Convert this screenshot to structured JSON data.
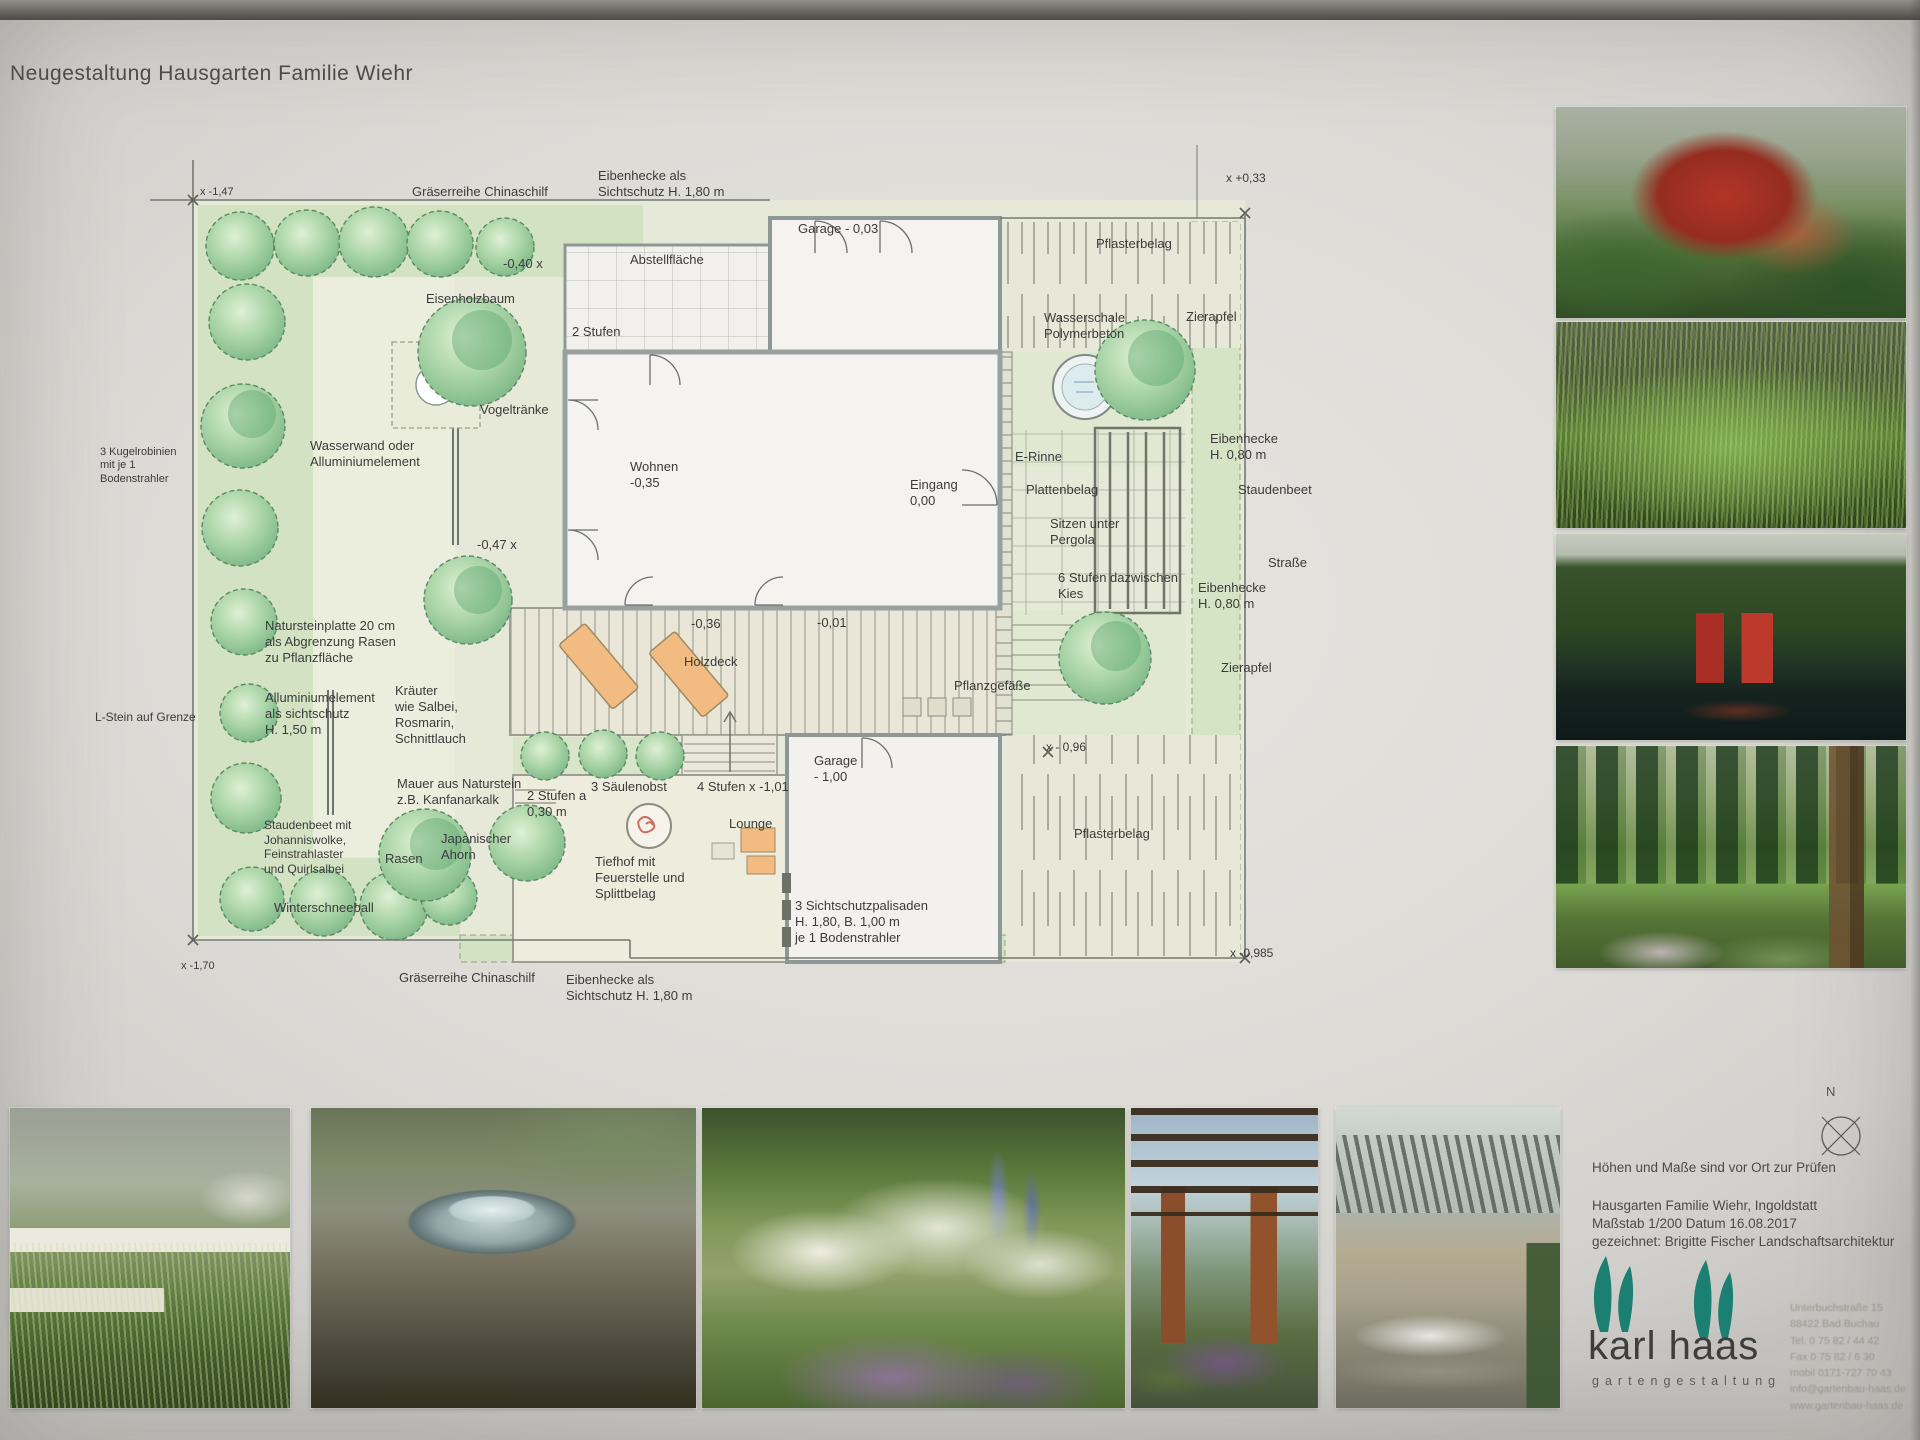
{
  "title": "Neugestaltung Hausgarten Familie Wiehr",
  "plan": {
    "labels": [
      {
        "t": "x -1,47",
        "x": 200,
        "y": 186,
        "fs": 11
      },
      {
        "t": "Gräserreihe Chinaschilf",
        "x": 412,
        "y": 184
      },
      {
        "t": "Eibenhecke als\nSichtschutz H. 1,80 m",
        "x": 598,
        "y": 168
      },
      {
        "t": "-0,40 x",
        "x": 503,
        "y": 256
      },
      {
        "t": "Abstellfläche",
        "x": 630,
        "y": 252
      },
      {
        "t": "2 Stufen",
        "x": 572,
        "y": 324
      },
      {
        "t": "Eisenholzbaum",
        "x": 426,
        "y": 291
      },
      {
        "t": "Garage - 0,03",
        "x": 798,
        "y": 221
      },
      {
        "t": "Pflasterbelag",
        "x": 1096,
        "y": 236
      },
      {
        "t": "x +0,33",
        "x": 1226,
        "y": 171,
        "fs": 12
      },
      {
        "t": "Wasserschale\nPolymerbeton",
        "x": 1044,
        "y": 310
      },
      {
        "t": "Zierapfel",
        "x": 1186,
        "y": 309
      },
      {
        "t": "Eibenhecke\nH. 0,80 m",
        "x": 1210,
        "y": 431
      },
      {
        "t": "Staudenbeet",
        "x": 1238,
        "y": 482
      },
      {
        "t": "Straße",
        "x": 1268,
        "y": 555
      },
      {
        "t": "Eibenhecke\nH. 0,80 m",
        "x": 1198,
        "y": 580
      },
      {
        "t": "Zierapfel",
        "x": 1221,
        "y": 660
      },
      {
        "t": "x - 0,96",
        "x": 1046,
        "y": 740,
        "fs": 12
      },
      {
        "t": "Wohnen\n-0,35",
        "x": 630,
        "y": 459
      },
      {
        "t": "Eingang\n0,00",
        "x": 910,
        "y": 477
      },
      {
        "t": "E-Rinne",
        "x": 1015,
        "y": 449
      },
      {
        "t": "Plattenbelag",
        "x": 1026,
        "y": 482
      },
      {
        "t": "Sitzen unter\nPergola",
        "x": 1050,
        "y": 516
      },
      {
        "t": "6 Stufen dazwischen\nKies",
        "x": 1058,
        "y": 570
      },
      {
        "t": "Vogeltränke",
        "x": 480,
        "y": 402
      },
      {
        "t": "Wasserwand oder\nAlluminiumelement",
        "x": 310,
        "y": 438
      },
      {
        "t": "3 Kugelrobinien\nmit je 1\nBodenstrahler",
        "x": 100,
        "y": 446,
        "fs": 11
      },
      {
        "t": "-0,47 x",
        "x": 477,
        "y": 537
      },
      {
        "t": "Natursteinplatte 20 cm\nals Abgrenzung Rasen\nzu Pflanzfläche",
        "x": 265,
        "y": 618
      },
      {
        "t": "Alluminiumelement\nals sichtschutz\nH. 1,50 m",
        "x": 265,
        "y": 690
      },
      {
        "t": "L-Stein auf Grenze",
        "x": 95,
        "y": 710,
        "fs": 12
      },
      {
        "t": "Kräuter\nwie Salbei,\nRosmarin,\nSchnittlauch",
        "x": 395,
        "y": 683
      },
      {
        "t": "Mauer aus Naturstein\nz.B. Kanfanarkalk",
        "x": 397,
        "y": 776
      },
      {
        "t": "Staudenbeet mit\nJohanniswolke,\nFeinstrahlaster\nund Quirlsalbei",
        "x": 264,
        "y": 818,
        "fs": 12
      },
      {
        "t": "Winterschneeball",
        "x": 274,
        "y": 900
      },
      {
        "t": "Rasen",
        "x": 385,
        "y": 851
      },
      {
        "t": "Japanischer\nAhorn",
        "x": 441,
        "y": 831
      },
      {
        "t": "Holzdeck",
        "x": 684,
        "y": 654
      },
      {
        "t": "-0,36",
        "x": 691,
        "y": 616
      },
      {
        "t": "-0,01",
        "x": 817,
        "y": 615
      },
      {
        "t": "Pflanzgefäße",
        "x": 954,
        "y": 678
      },
      {
        "t": "2 Stufen a\n0,30 m",
        "x": 527,
        "y": 788
      },
      {
        "t": "3 Säulenobst",
        "x": 591,
        "y": 779
      },
      {
        "t": "4 Stufen  x -1,01",
        "x": 697,
        "y": 779
      },
      {
        "t": "Lounge",
        "x": 729,
        "y": 816
      },
      {
        "t": "Tiefhof mit\nFeuerstelle und\nSplittbelag",
        "x": 595,
        "y": 854
      },
      {
        "t": "Garage\n- 1,00",
        "x": 814,
        "y": 753
      },
      {
        "t": "3 Sichtschutzpalisaden\nH. 1,80, B. 1,00 m\nje 1 Bodenstrahler",
        "x": 795,
        "y": 898
      },
      {
        "t": "Pflasterbelag",
        "x": 1074,
        "y": 826
      },
      {
        "t": "x -0,985",
        "x": 1230,
        "y": 946,
        "fs": 12
      },
      {
        "t": "Gräserreihe Chinaschilf",
        "x": 399,
        "y": 970
      },
      {
        "t": "Eibenhecke als\nSichtschutz H. 1,80 m",
        "x": 566,
        "y": 972
      },
      {
        "t": "x -1,70",
        "x": 181,
        "y": 960,
        "fs": 11
      }
    ]
  },
  "info_block": {
    "note": "Höhen und Maße sind vor Ort zur Prüfen",
    "project": "Hausgarten Familie Wiehr, Ingoldstatt",
    "scale_date": "Maßstab 1/200 Datum 16.08.2017",
    "drawn_by": "gezeichnet: Brigitte Fischer Landschaftsarchitektur",
    "compass": "N"
  },
  "logo": {
    "name": "karl haas",
    "subtitle": "gartengestaltung",
    "address_lines": [
      "Unterbuchstraße 15",
      "88422 Bad Buchau",
      "Tel. 0 75 82 / 44 42",
      "Fax 0 75 82 / 6 30",
      "mobil 0171-727 70 43",
      "info@gartenbau-haas.de",
      "www.gartenbau-haas.de"
    ]
  },
  "side_photos": [
    {
      "description": "Roter Fächerahorn im Garten"
    },
    {
      "description": "Ziergräser vor dunklem Hintergrund"
    },
    {
      "description": "Hecke mit roten Wandelementen und Wasserbecken"
    },
    {
      "description": "Säulenbäume mit Staudenbeet"
    }
  ],
  "bottom_photos": [
    {
      "description": "Gräsergarten mit weißen Mauern"
    },
    {
      "description": "Wasserschale aus Stein"
    },
    {
      "description": "Staudenbeet in Weiß und Violett"
    },
    {
      "description": "Pergola mit Ziegelsäulen"
    },
    {
      "description": "Moderne Lamellen-Pergola mit Sitzgruppe"
    }
  ]
}
